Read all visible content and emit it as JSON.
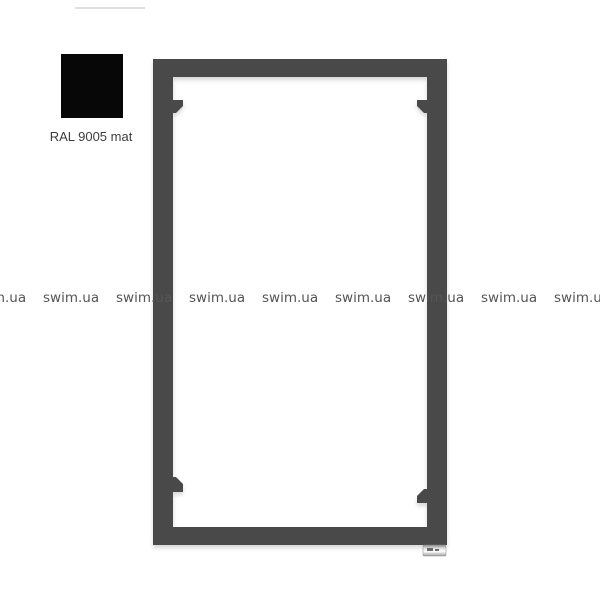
{
  "image": {
    "width": 600,
    "height": 600,
    "background": "#ffffff"
  },
  "swatch": {
    "label": "RAL 9005 mat",
    "color": "#070707"
  },
  "watermark": {
    "text": "swim.ua",
    "count": 9,
    "pitch_px": 73,
    "color": "#555555"
  },
  "radiator": {
    "color": "#484848",
    "frame": {
      "x": 153,
      "y": 59,
      "width": 294,
      "height": 486,
      "post_width": 20,
      "bar_thickness": 18,
      "rung_thickness": 17
    },
    "rungs": [
      {
        "left_y": 135,
        "right_y": 120
      },
      {
        "left_y": 192,
        "right_y": 205
      },
      {
        "left_y": 275,
        "right_y": 260
      },
      {
        "left_y": 335,
        "right_y": 344
      },
      {
        "left_y": 410,
        "right_y": 394
      },
      {
        "left_y": 467,
        "right_y": 479
      }
    ],
    "corner_tabs": [
      {
        "x": 173,
        "y": 100,
        "w": 10,
        "h": 13,
        "cut": "br"
      },
      {
        "x": 417,
        "y": 100,
        "w": 10,
        "h": 13,
        "cut": "bl"
      },
      {
        "x": 173,
        "y": 477,
        "w": 10,
        "h": 15,
        "cut": "tr"
      },
      {
        "x": 417,
        "y": 489,
        "w": 10,
        "h": 14,
        "cut": "tl"
      }
    ],
    "valve": {
      "x": 423,
      "y": 545,
      "w": 23,
      "h": 11,
      "marks": [
        [
          427,
          548,
          6,
          3
        ],
        [
          435,
          549,
          4,
          2
        ]
      ]
    }
  }
}
